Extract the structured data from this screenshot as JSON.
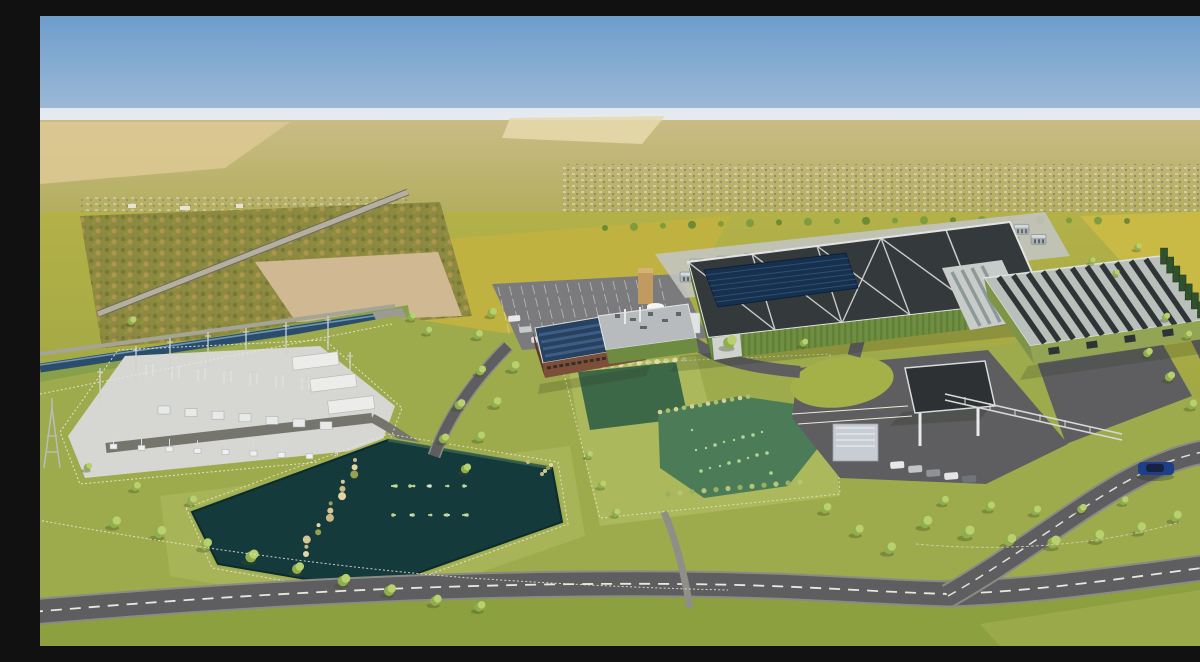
{
  "image": {
    "kind": "architectural-rendering",
    "view": "aerial-birds-eye",
    "subject": "data-center campus with electrical substation, retention ponds, access roads, landscaping and open farmland to the horizon"
  },
  "palette": {
    "sky_top": "#6d9dcc",
    "sky_horizon": "#b6cbdd",
    "haze": "#eef1f2",
    "distant_field_tan": "#d3c18a",
    "field_yellow": "#c2b23f",
    "field_green": "#96a042",
    "campus_grass": "#9dab4c",
    "verge_grass": "#aab65a",
    "sand_patch": "#cfb892",
    "canal_water": "#2b4d6b",
    "road_asphalt": "#5e5e60",
    "road_edge": "#8b8b86",
    "road_marking": "#eae7de",
    "substation_pad": "#d6d6d2",
    "equipment_white": "#eef0f1",
    "pond_dark_teal": "#143a3c",
    "pond_green": "#4c7c57",
    "pond_algae": "#b8d898",
    "reed_tan": "#cbb985",
    "tree_canopy": "#b9d06f",
    "tree_shade": "#8fae4e",
    "hedge_green": "#71903c",
    "main_roof_dark": "#34393c",
    "roof_seam_white": "#e3e4e1",
    "solar_panel_blue": "#17304d",
    "living_wall_green": "#708e41",
    "annex_wall_sage": "#93a455",
    "annex_roof_strip": "#2f3437",
    "generator_dark_green": "#31502c",
    "office_brick": "#7c4f3b",
    "tank_white": "#e9ebec",
    "gate_canopy_dark": "#2e3134",
    "car_blue": "#1d3f8a",
    "fence_white": "#eee9da"
  },
  "scene": {
    "elements": [
      "sky",
      "horizon-haze",
      "distant-farmland",
      "distant-town",
      "country-road",
      "canal",
      "electrical-substation",
      "transmission-pylon",
      "dark-retention-pond",
      "wetland-pond",
      "office-building-solar-roof",
      "parking-lot",
      "storage-tanks",
      "data-hall-dark-roof",
      "rooftop-solar-array",
      "cooling-plant-row",
      "living-wall-facade",
      "annex-data-hall",
      "generator-row",
      "entrance-roundabout",
      "security-gatehouse",
      "perimeter-roads",
      "roadside-trees",
      "white-fences",
      "blue-car",
      "parked-cars"
    ]
  }
}
